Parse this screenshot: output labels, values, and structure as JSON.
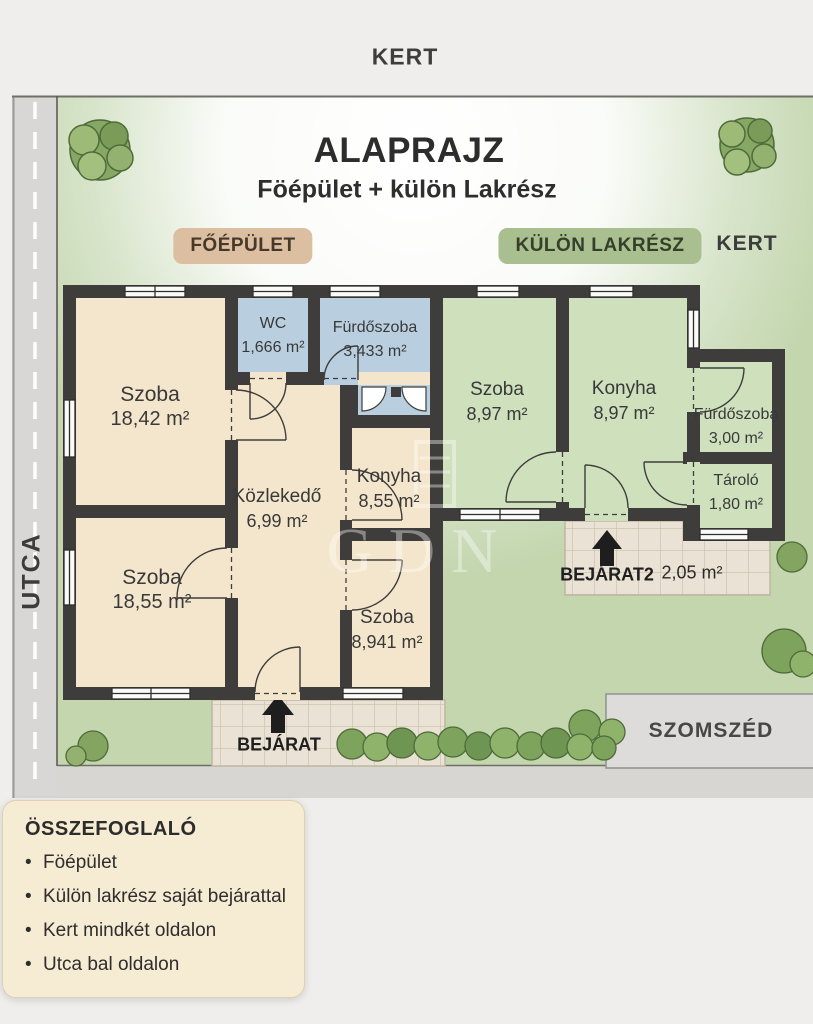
{
  "header": {
    "kert_top": "KERT"
  },
  "plan": {
    "title": "ALAPRAJZ",
    "subtitle": "Föépület + külön Lakrész",
    "badge_main": "FŐÉPÜLET",
    "badge_separate": "KÜLÖN LAKRÉSZ",
    "kert_side": "KERT",
    "street": "UTCA",
    "neighbor": "SZOMSZÉD",
    "entrance1_label": "BEJÁRAT",
    "entrance2_label": "BEJÁRAT2",
    "entrance2_area": "2,05 m²",
    "watermark": "GDN"
  },
  "rooms": {
    "szoba1": {
      "name": "Szoba",
      "area": "18,42 m²"
    },
    "wc": {
      "name": "WC",
      "area": "1,666 m²"
    },
    "furdoszoba1": {
      "name": "Fürdőszoba",
      "area": "3,433 m²"
    },
    "kozlekedo": {
      "name": "Közlekedő",
      "area": "6,99 m²"
    },
    "konyha1": {
      "name": "Konyha",
      "area": "8,55 m²"
    },
    "szoba2": {
      "name": "Szoba",
      "area": "18,55 m²"
    },
    "szoba3": {
      "name": "Szoba",
      "area": "8,941 m²"
    },
    "szoba4": {
      "name": "Szoba",
      "area": "8,97 m²"
    },
    "konyha2": {
      "name": "Konyha",
      "area": "8,97 m²"
    },
    "furdoszoba2": {
      "name": "Fürdőszoba",
      "area": "3,00 m²"
    },
    "tarolo": {
      "name": "Tároló",
      "area": "1,80 m²"
    }
  },
  "summary": {
    "title": "ÖSSZEFOGLALÓ",
    "items": [
      "Föépület",
      "Külön lakrész saját bejárattal",
      "Kert mindkét oldalon",
      "Utca bal oldalon"
    ]
  },
  "colors": {
    "wall": "#3e3d3b",
    "main_room_fill": "#f4e6cc",
    "bath_fill": "#b9cfe0",
    "separate_room_fill": "#cfe0bd",
    "badge_main_bg": "#dcbfa0",
    "badge_separate_bg": "#a9bf90",
    "garden_green": "#c3d6ae",
    "road_gray": "#d8d7d5",
    "paving": "#eae2d4",
    "neighbor_gray": "#dddcda",
    "summary_card_bg": "#f6ebd3"
  }
}
